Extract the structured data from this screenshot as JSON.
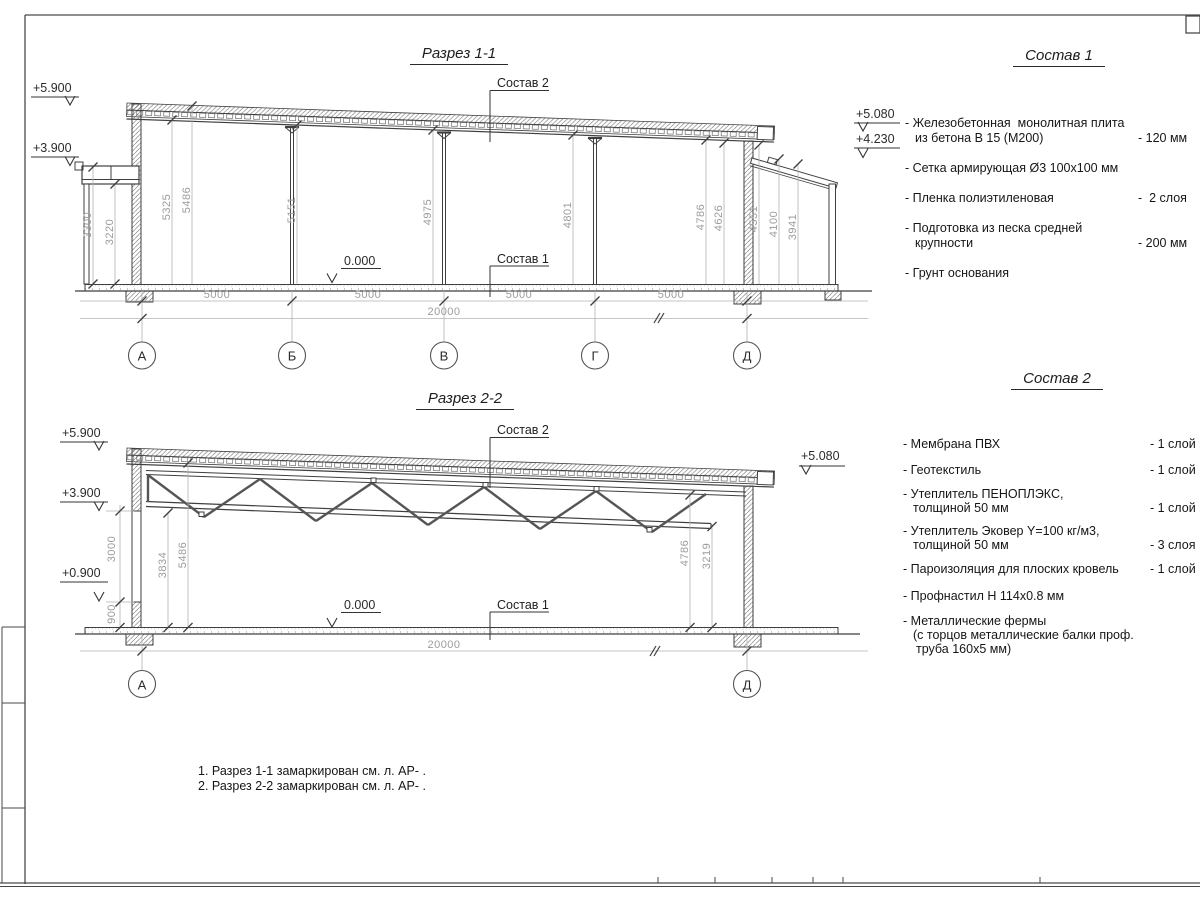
{
  "sections": {
    "s1": {
      "title": "Разрез 1-1",
      "elev": {
        "e59": "+5.900",
        "e39": "+3.900",
        "e508": "+5.080",
        "e423": "+4.230"
      },
      "zero": "0.000",
      "callout_roof": "Состав 2",
      "callout_floor": "Состав 1",
      "vdims": [
        "3300",
        "3220",
        "5325",
        "5486",
        "5151",
        "4975",
        "4801",
        "4786",
        "4626",
        "4551",
        "4100",
        "3941"
      ],
      "hdims": [
        "5000",
        "5000",
        "5000",
        "5000"
      ],
      "total": "20000",
      "axes": [
        "А",
        "Б",
        "В",
        "Г",
        "Д"
      ]
    },
    "s2": {
      "title": "Разрез 2-2",
      "elev": {
        "e59": "+5.900",
        "e39": "+3.900",
        "e09": "+0.900",
        "e508": "+5.080"
      },
      "zero": "0.000",
      "callout_roof": "Состав 2",
      "callout_floor": "Состав 1",
      "vdims": [
        "3000",
        "900",
        "3834",
        "5486",
        "4786",
        "3219"
      ],
      "total": "20000",
      "axes": [
        "А",
        "Д"
      ]
    }
  },
  "legend1": {
    "title": "Состав 1",
    "items": [
      {
        "lines": [
          "- Железобетонная  монолитная плита",
          "из бетона В 15 (М200)"
        ],
        "value": "- 120 мм"
      },
      {
        "lines": [
          "- Сетка армирующая Ø3 100х100 мм"
        ],
        "value": ""
      },
      {
        "lines": [
          "- Пленка полиэтиленовая"
        ],
        "value": "-  2 слоя"
      },
      {
        "lines": [
          "- Подготовка из песка средней",
          "крупности"
        ],
        "value": "- 200 мм"
      },
      {
        "lines": [
          "- Грунт основания"
        ],
        "value": ""
      }
    ]
  },
  "legend2": {
    "title": "Состав 2",
    "items": [
      {
        "lines": [
          "- Мембрана ПВХ"
        ],
        "value": "- 1 слой"
      },
      {
        "lines": [
          "- Геотекстиль"
        ],
        "value": "- 1 слой"
      },
      {
        "lines": [
          "- Утеплитель ПЕНОПЛЭКС,",
          "толщиной 50 мм"
        ],
        "value": "- 1 слой"
      },
      {
        "lines": [
          "- Утеплитель Эковер Y=100 кг/м3,",
          "толщиной 50 мм"
        ],
        "value": "- 3 слоя"
      },
      {
        "lines": [
          "- Пароизоляция для плоских кровель"
        ],
        "value": "- 1 слой"
      },
      {
        "lines": [
          "- Профнастил Н 114х0.8 мм"
        ],
        "value": ""
      },
      {
        "lines": [
          "- Металлические фермы",
          "(с торцов металлические балки проф.",
          "труба 160х5 мм)"
        ],
        "value": ""
      }
    ]
  },
  "notes": [
    "1. Разрез 1-1 замаркирован см. л. АР- .",
    "2. Разрез 2-2 замаркирован см. л. АР- ."
  ]
}
